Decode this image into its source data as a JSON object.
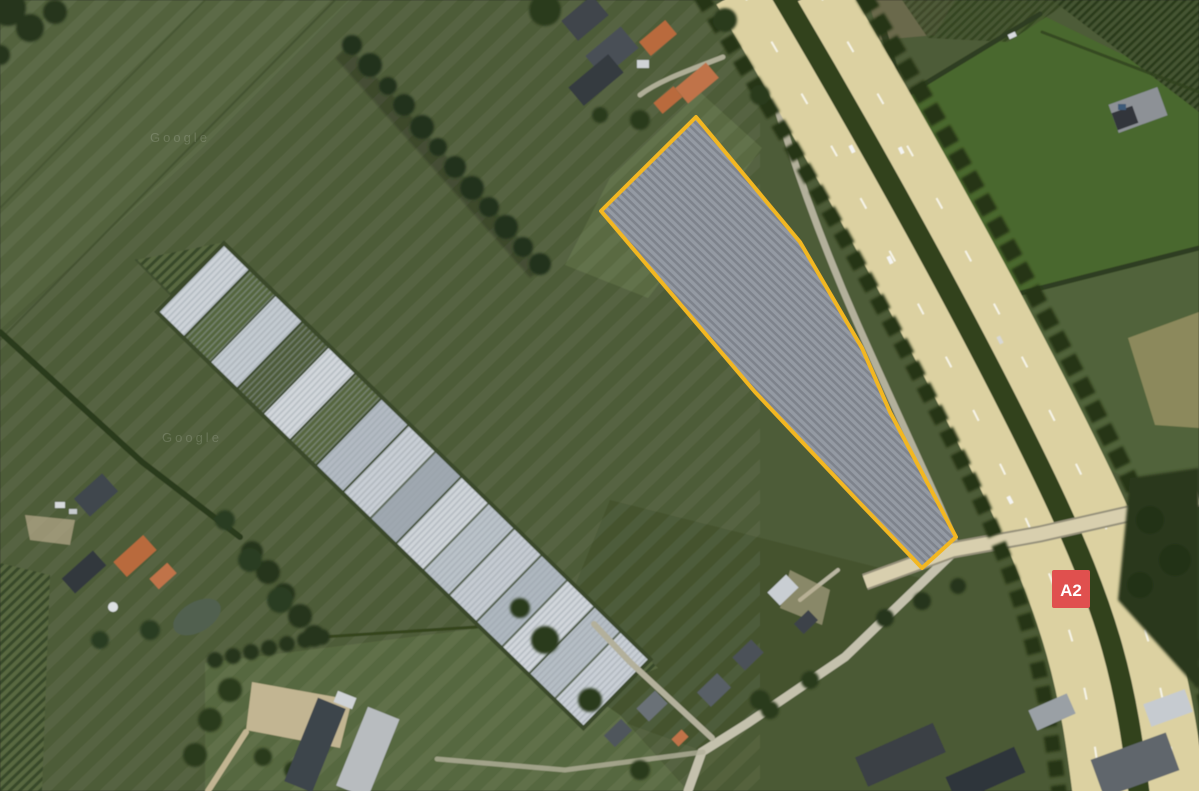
{
  "map": {
    "view_label": "satellite-farmland-along-motorway",
    "watermarks": [
      "Google",
      "Google"
    ],
    "road_badge": {
      "label": "A2",
      "color": "#e0504e",
      "text_color": "#ffffff"
    },
    "parcel": {
      "points": "696,117 601,211 755,392 857,500 922,568 956,537 890,412 862,348 800,242",
      "stroke": "#f2b722",
      "stroke_width": 4
    },
    "highway": {
      "surface_color": "#dcd1a1",
      "median_color": "#33431f",
      "carriageway_west_d": "M741,-10 C830,140 929,318 1002,468 S1088,686 1102,800",
      "carriageway_east_d": "M817,-10 C906,140 1005,318 1078,468 S1164,686 1178,800",
      "median_d": "M779,-10 C868,140 967,318 1040,468 S1126,686 1140,800",
      "service_road_d": "M746,-5 C768,80 798,190 858,325 S946,515 957,549",
      "overpass_d": "M865,582 L952,550 L1040,534 L1199,498",
      "local_road_d": "M957,549 L845,657 L748,723 L702,752 L688,791"
    },
    "colors": {
      "field_base": "#4e5c38",
      "field_dark": "#45532f",
      "field_bright": "#4a682e",
      "vineyard_row": "#394829",
      "greenhouse_light": "#cdd3d8",
      "trees": "#263619",
      "road_local": "#c4c1ad",
      "parcel_fill_light": "#949aa3",
      "parcel_fill_dark": "#7e838c"
    }
  }
}
